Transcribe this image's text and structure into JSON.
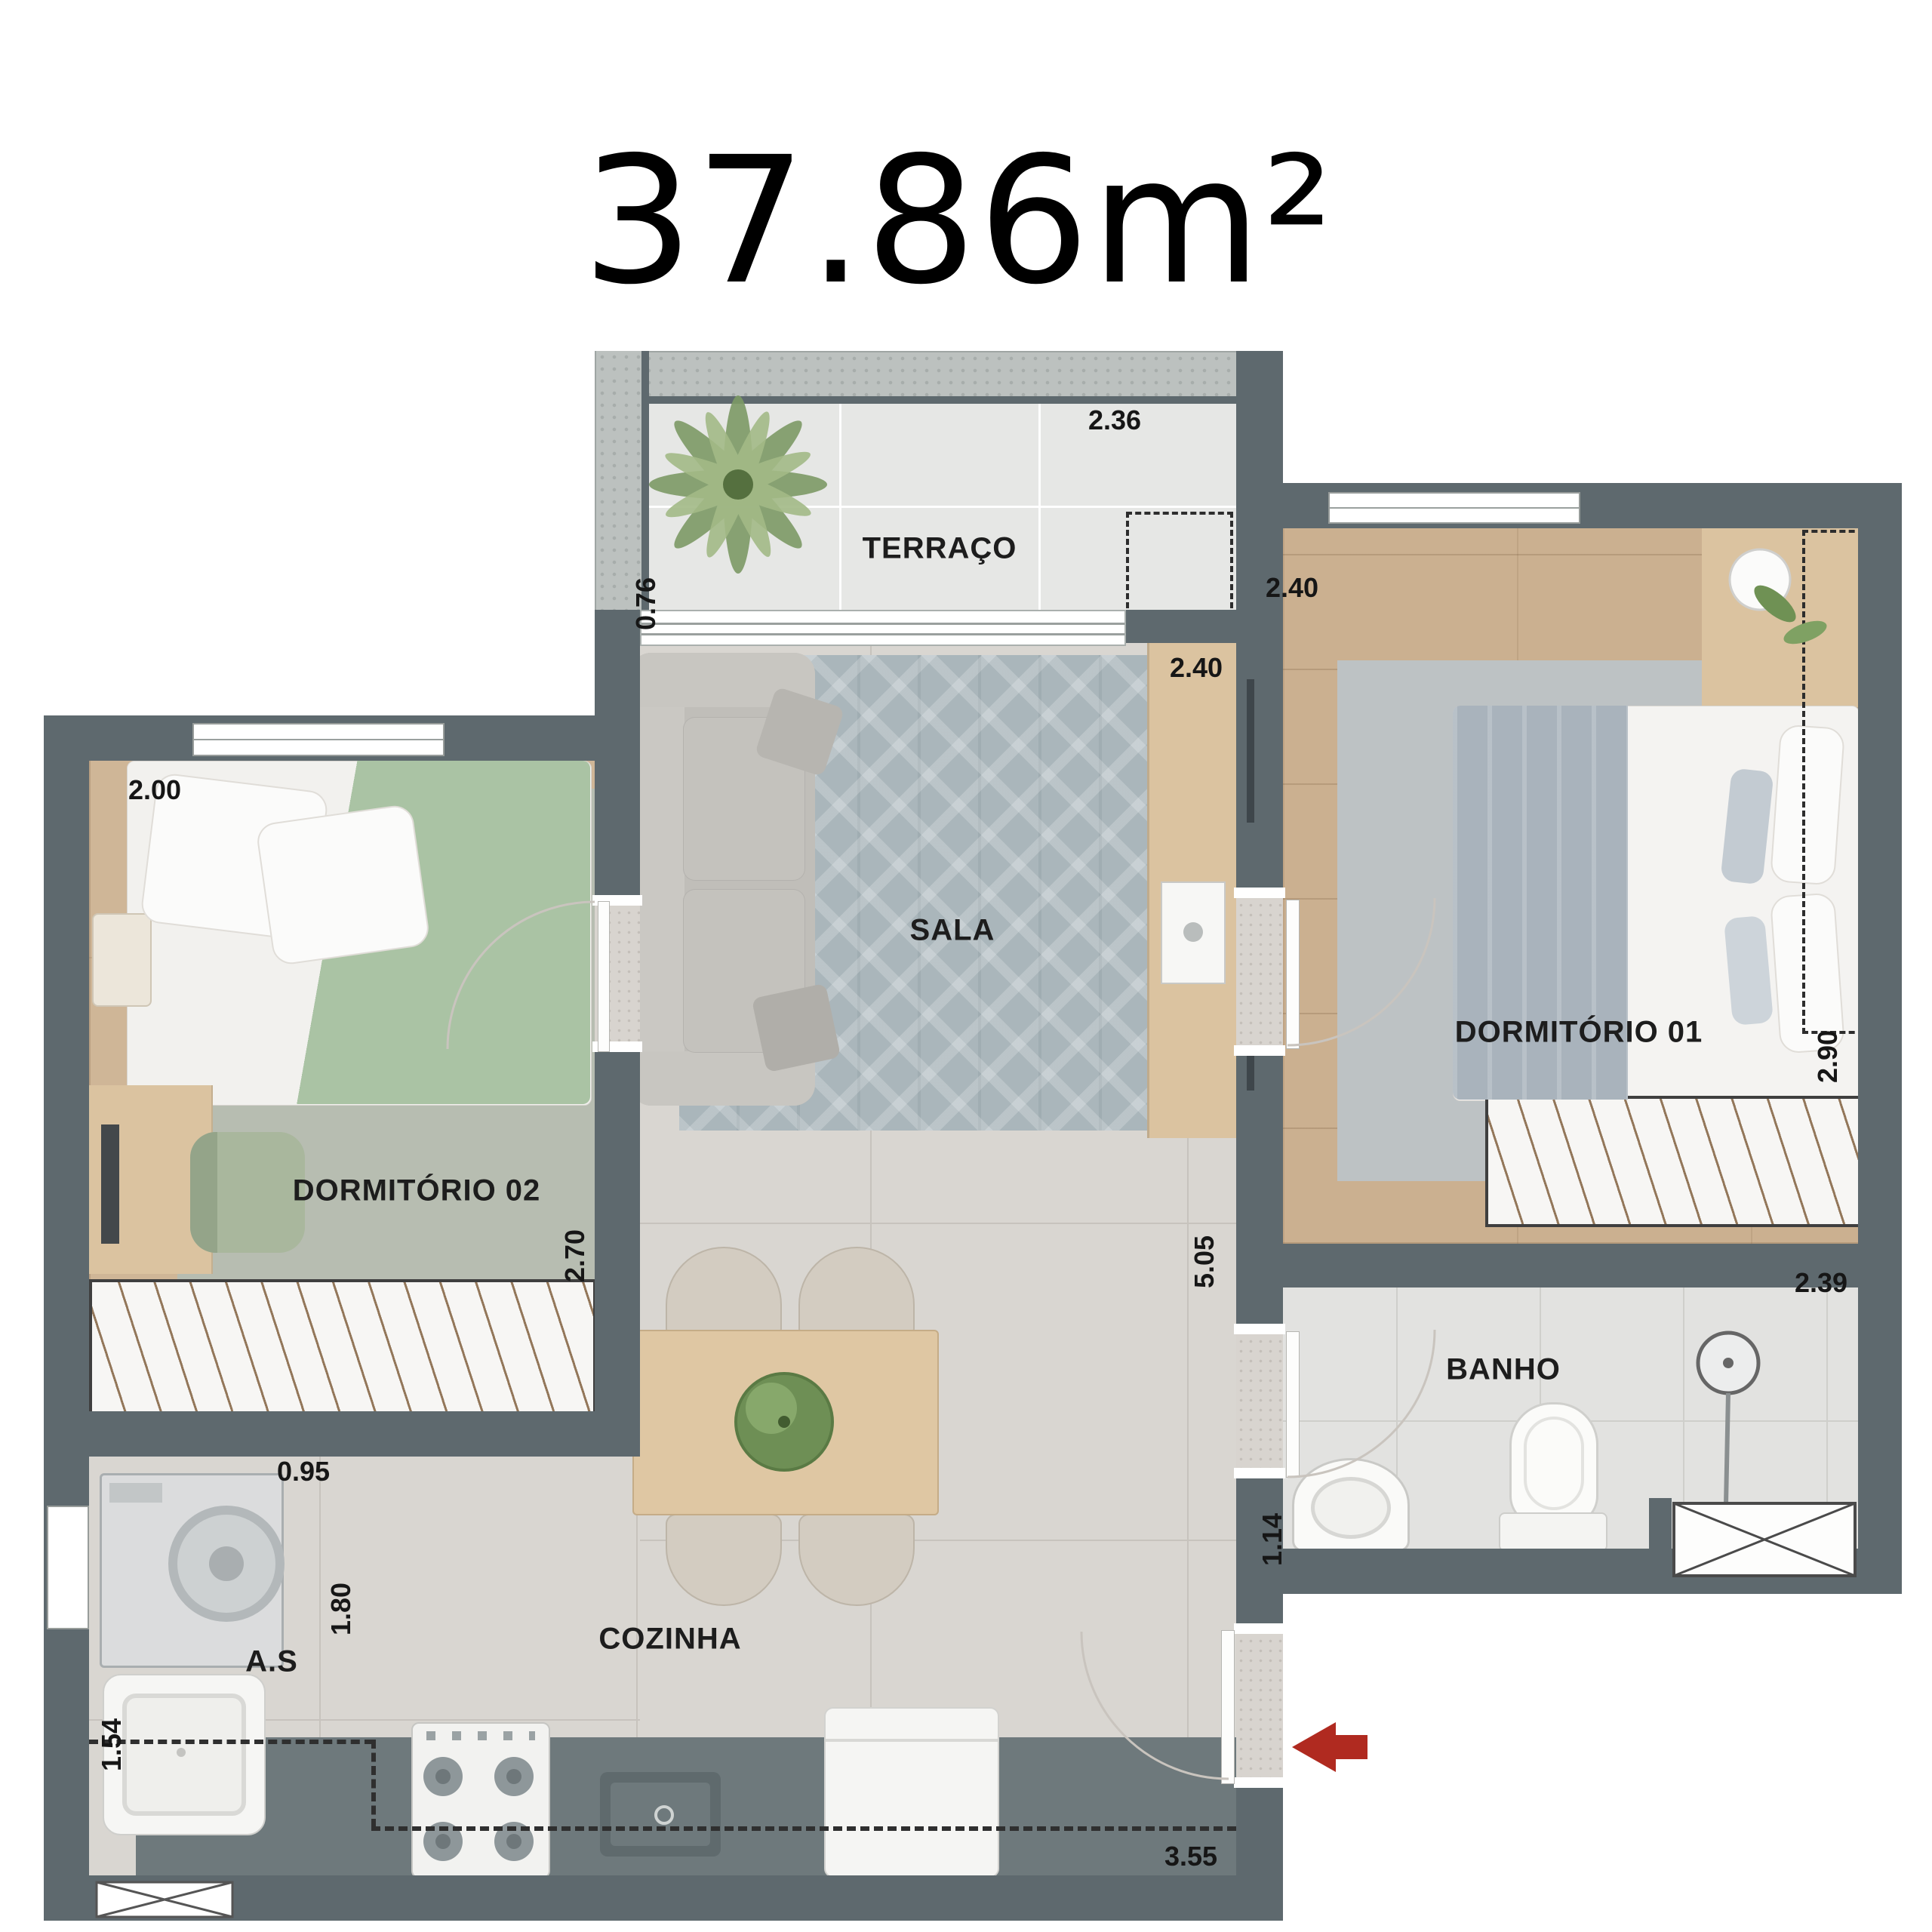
{
  "title": "37.86m²",
  "rooms": {
    "terraco": {
      "label": "TERRAÇO",
      "dim_width": "2.36",
      "dim_depth": "0.76"
    },
    "sala": {
      "label": "SALA",
      "dim_width": "2.40"
    },
    "dormitorio1": {
      "label": "DORMITÓRIO 01",
      "dim_width": "2.40",
      "dim_depth": "2.90"
    },
    "dormitorio2": {
      "label": "DORMITÓRIO 02",
      "dim_width": "2.00",
      "dim_depth": "2.70"
    },
    "banho": {
      "label": "BANHO",
      "dim_width": "2.39",
      "dim_depth": "1.14"
    },
    "cozinha": {
      "label": "COZINHA",
      "dim_width": "3.55",
      "dim_depth": "1.80"
    },
    "area_servico": {
      "label": "A.S",
      "dim_width": "0.95",
      "dim_depth": "1.54"
    },
    "circulacao": {
      "dim_length": "5.05"
    }
  },
  "colors": {
    "wall": "#5e696e",
    "wall_masonry": "#bcc1bf",
    "entrance_arrow": "#b02a20",
    "wood_floor": "#cbb090",
    "tile_floor": "#d9d6d1",
    "label_text": "#1d1d1d"
  }
}
